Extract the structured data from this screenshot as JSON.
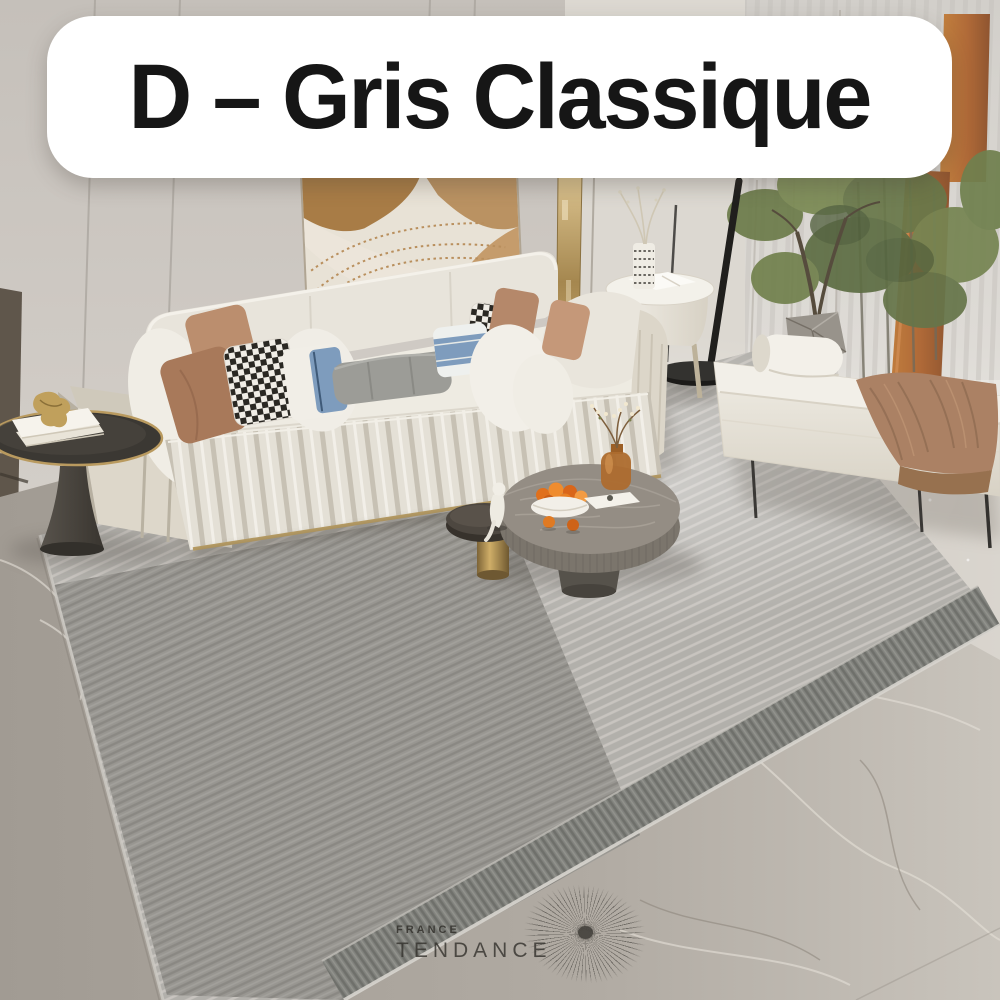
{
  "banner": {
    "label": "D – Gris Classique",
    "bg": "#ffffff",
    "text_color": "#161616"
  },
  "watermark": {
    "line1": "FRANCE",
    "line2": "TENDANCE",
    "icon": "starburst-icon"
  },
  "palette": {
    "wall": "#cbc6c0",
    "right_wall": "#dcd8d1",
    "curtain_sheer": "#d8d5d0",
    "curtain_accent": "#b5703f",
    "art_brown": "#a87c46",
    "mirror_gold": "#c2a468",
    "sofa": "#e6e2d9",
    "sofa_trim_gold": "#b89d64",
    "pillow_terracotta": "#a8795a",
    "pillow_blue": "#7e9cbd",
    "pillow_gray": "#9c9c97",
    "pillow_check_dark": "#2a2823",
    "rug": "#b2b0ab",
    "rug_dark_field": "#97958f",
    "rug_border_band": "#82837e",
    "marble": "#a8a29b",
    "bench": "#ebe7de",
    "blanket": "#ab8164",
    "plant_green": "#6d7c4b",
    "fruit_orange": "#e0701c",
    "lamp_black": "#201f1d",
    "table_gold": "#b99a5f"
  },
  "scene": {
    "objects": [
      "grey striped area rug with dark border band",
      "cream channel-tufted sofa with pillows",
      "abstract wall art",
      "gold wall mirror strip",
      "black round side table with books and gold figurine",
      "round stone coffee table with fruit bowl and amber vase",
      "small gold-base nesting table with white figurine",
      "white oval end table with vase",
      "black floor lamp",
      "potted olive tree and bamboo stems",
      "sheer curtains with rust drape",
      "cream bench with bolster and brown throw",
      "grey marble floor"
    ]
  }
}
